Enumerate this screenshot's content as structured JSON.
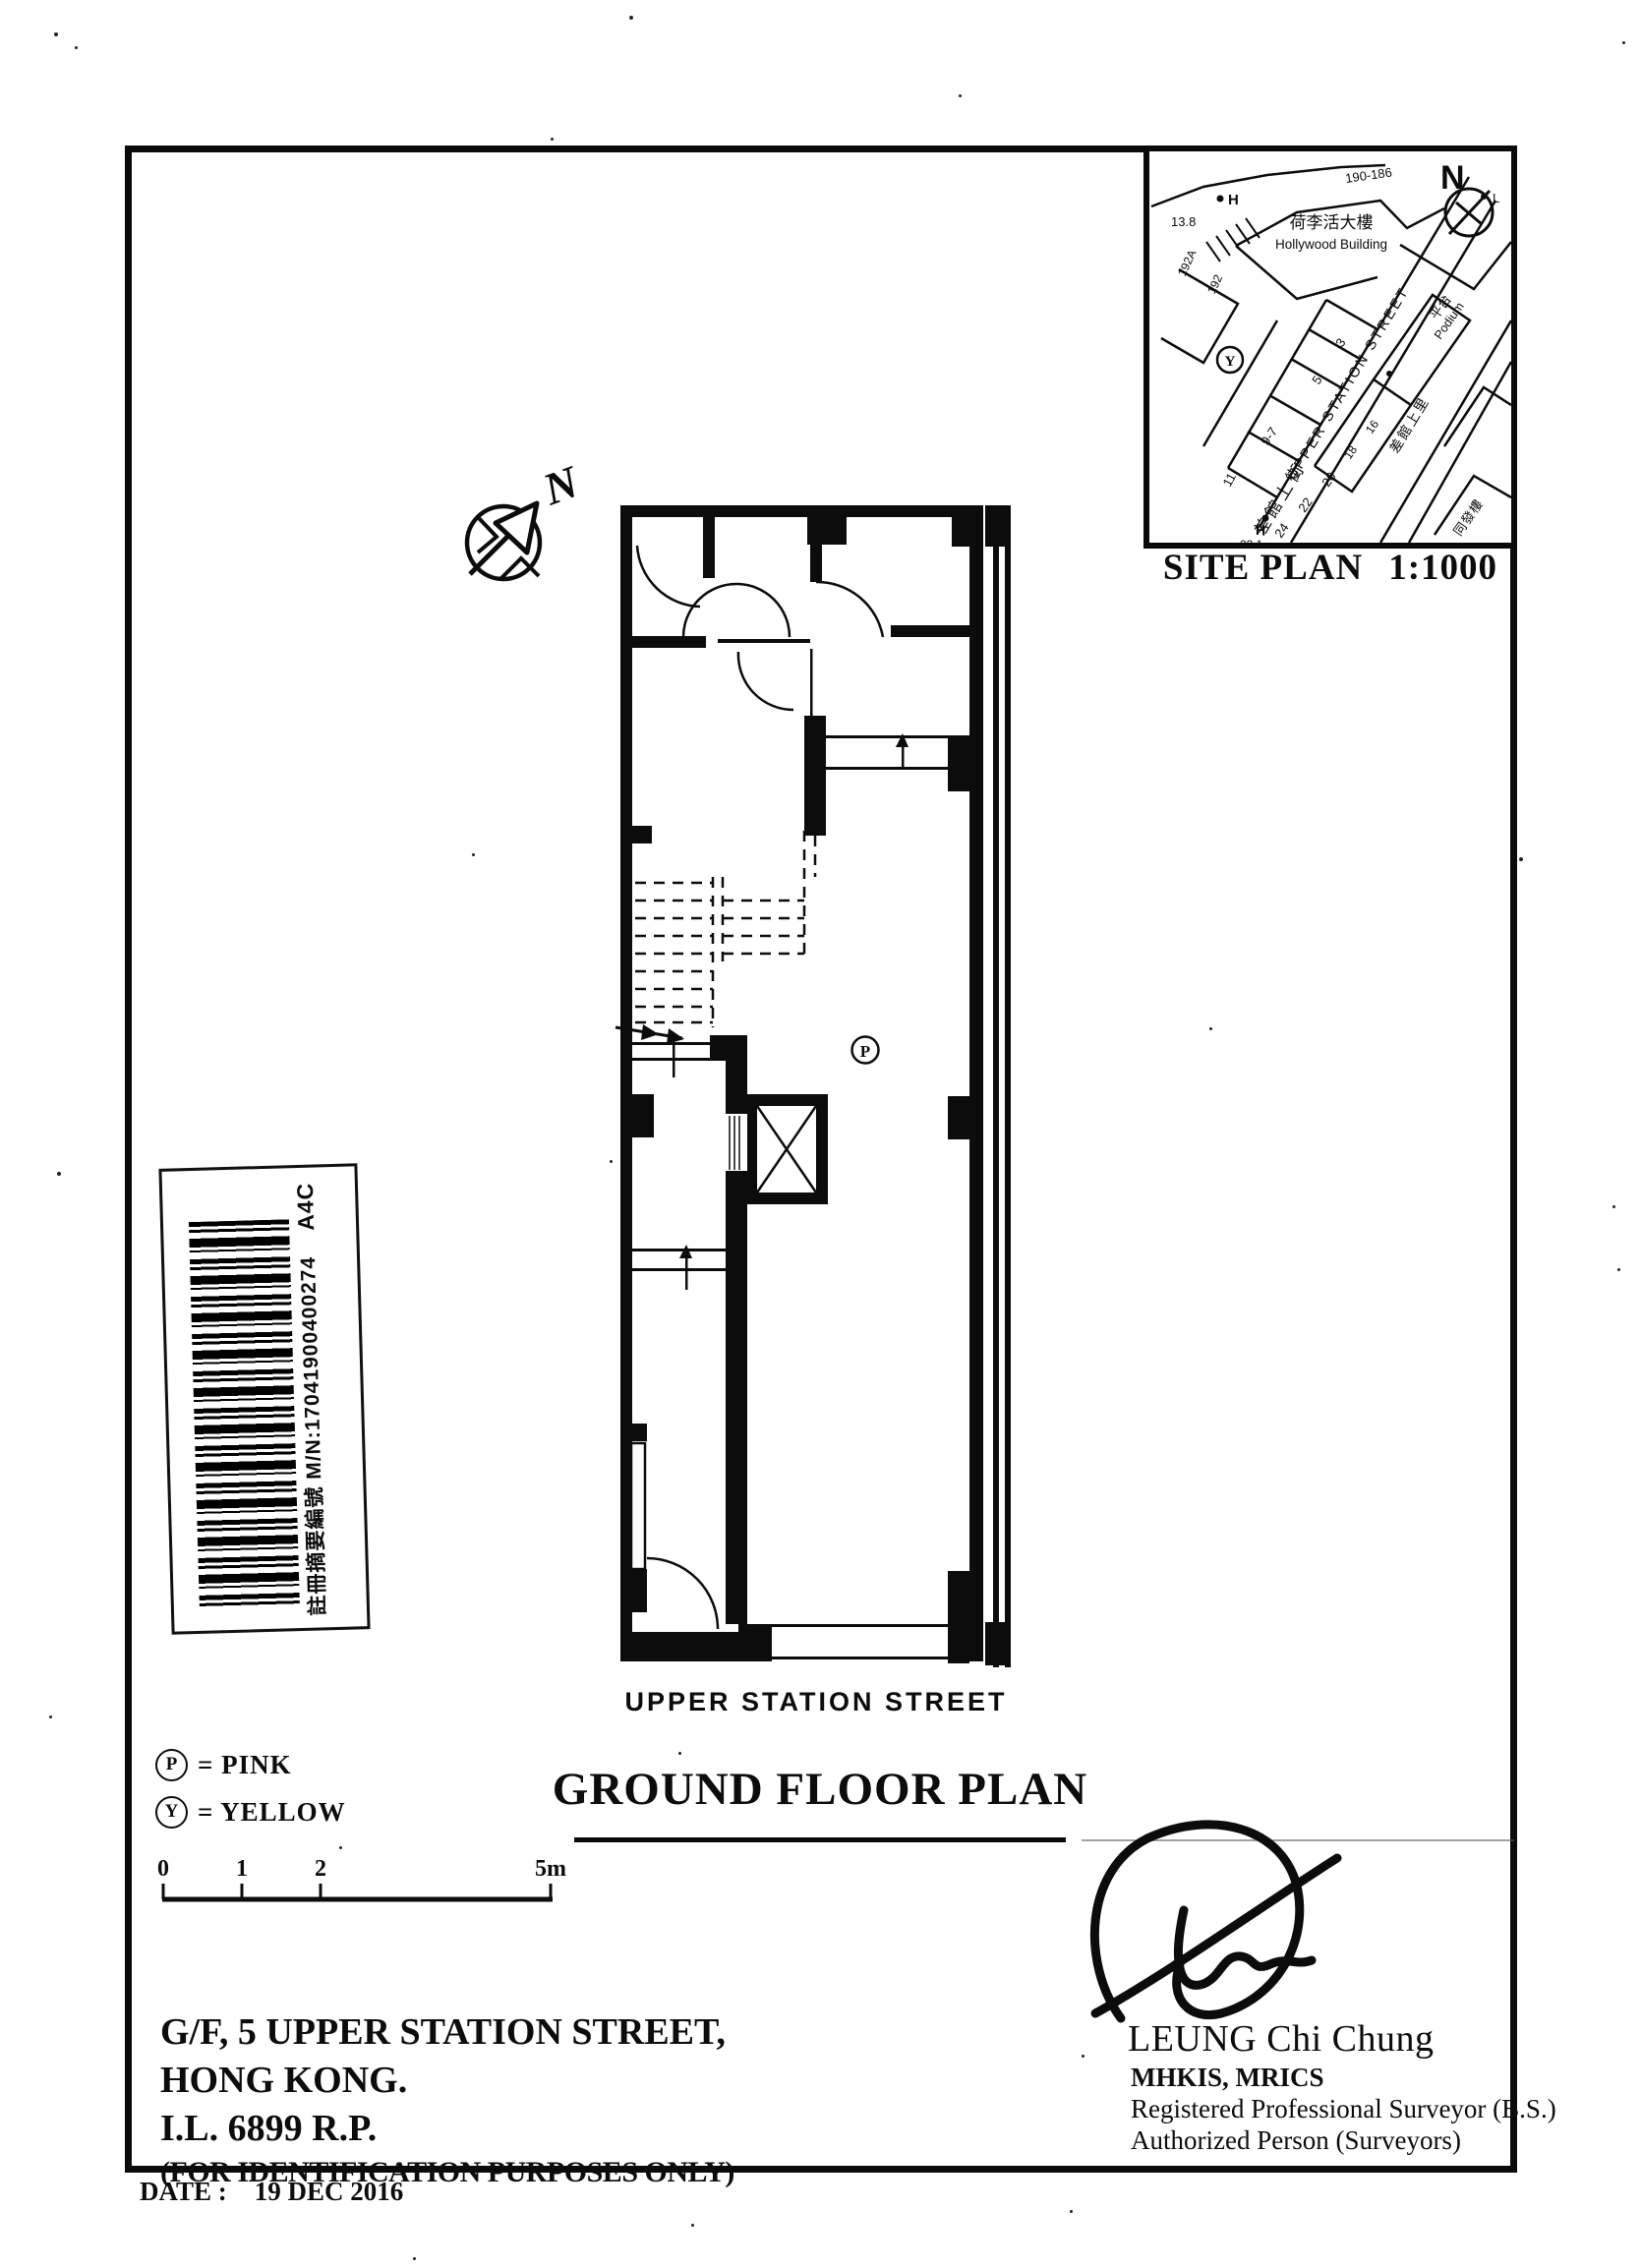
{
  "document": {
    "title": "GROUND FLOOR PLAN",
    "street_label": "UPPER STATION STREET",
    "address_line1": "G/F, 5 UPPER STATION STREET,",
    "address_line2": "HONG KONG.",
    "address_line3": "I.L. 6899 R.P.",
    "address_line4": "(FOR IDENTIFICATION PURPOSES ONLY)",
    "date_label": "DATE :",
    "date_value": "19 DEC 2016"
  },
  "site_plan": {
    "caption_left": "SITE PLAN",
    "caption_right": "1:1000",
    "labels": {
      "range_top": "190-186",
      "h_top": "H",
      "spot_top": "13.8",
      "building_cn": "荷李活大樓",
      "building_en": "Hollywood Building",
      "north": "N",
      "l_marker": "L",
      "street_en": "UPPER STATION STREET",
      "street_cn": "差館上街",
      "lane_cn": "差館上里",
      "building2_cn": "同發樓",
      "podium_cn": "平台",
      "podium_en": "Podium",
      "y_marker": "Y",
      "h_bottom": "H",
      "spot_bottom": "23.1",
      "no_192a": "192A",
      "no_192": "192",
      "no_3": "3",
      "no_5": "5",
      "no_9_7": "9-7",
      "no_11": "11",
      "no_24": "24",
      "no_22": "22",
      "no_20": "20",
      "no_18": "18",
      "no_16": "16"
    }
  },
  "north_arrow": {
    "label": "N"
  },
  "plan": {
    "p_marker": "P"
  },
  "legend": {
    "p_symbol": "P",
    "p_label": "= PINK",
    "y_symbol": "Y",
    "y_label": "= YELLOW"
  },
  "scale_bar": {
    "t0": "0",
    "t1": "1",
    "t2": "2",
    "t5": "5m"
  },
  "barcode": {
    "text": "註冊摘要編號  M/N:17041900400274",
    "suffix": "A4C"
  },
  "signature": {
    "name": "LEUNG Chi Chung",
    "credentials": "MHKIS, MRICS",
    "line3": "Registered Professional Surveyor (B.S.)",
    "line4": "Authorized Person (Surveyors)"
  }
}
